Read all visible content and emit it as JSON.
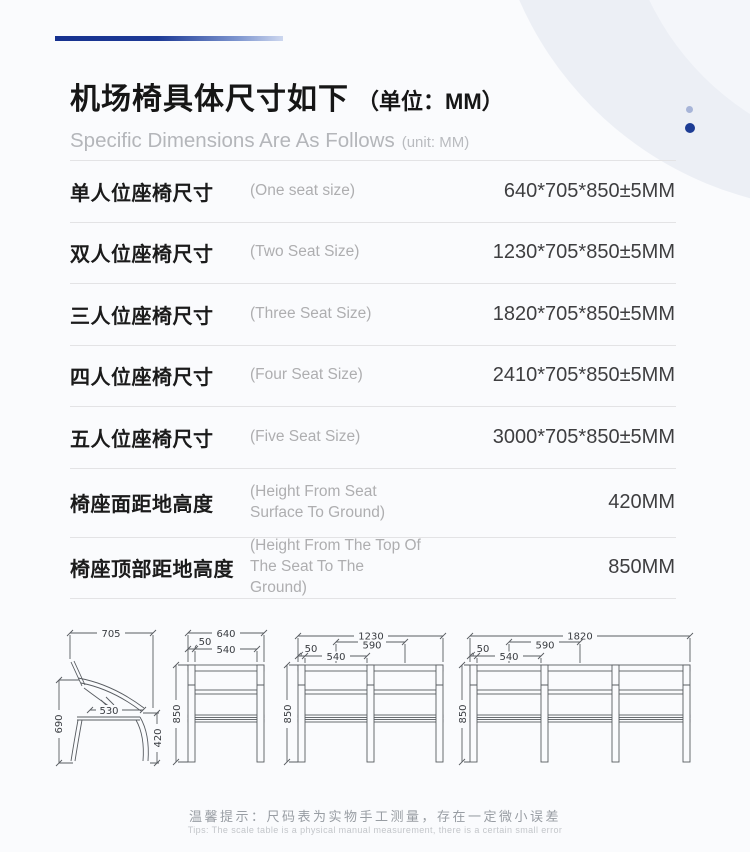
{
  "header": {
    "title_zh": "机场椅具体尺寸如下",
    "title_unit": "（单位：MM）",
    "subtitle_en": "Specific Dimensions Are As Follows",
    "subtitle_unit": "(unit: MM)"
  },
  "spec_table": {
    "rows": [
      {
        "label_zh": "单人位座椅尺寸",
        "label_en": "(One seat size)",
        "value": "640*705*850±5MM"
      },
      {
        "label_zh": "双人位座椅尺寸",
        "label_en": "(Two Seat Size)",
        "value": "1230*705*850±5MM"
      },
      {
        "label_zh": "三人位座椅尺寸",
        "label_en": "(Three Seat Size)",
        "value": "1820*705*850±5MM"
      },
      {
        "label_zh": "四人位座椅尺寸",
        "label_en": "(Four Seat Size)",
        "value": "2410*705*850±5MM"
      },
      {
        "label_zh": "五人位座椅尺寸",
        "label_en": "(Five Seat Size)",
        "value": "3000*705*850±5MM"
      },
      {
        "label_zh": "椅座面距地高度",
        "label_en": "(Height From Seat Surface To Ground)",
        "value": "420MM"
      },
      {
        "label_zh": "椅座顶部距地高度",
        "label_en": "(Height From The Top Of The Seat To The Ground)",
        "value": "850MM"
      }
    ]
  },
  "drawings": {
    "side_view": {
      "total_depth": "705",
      "total_height": "690",
      "seat_depth": "530",
      "seat_height": "420"
    },
    "front_single": {
      "total_width": "640",
      "armrest": "50",
      "seat_width": "540",
      "total_height": "850"
    },
    "front_double": {
      "total_width": "1230",
      "seat_pitch": "590",
      "seat_width": "540",
      "armrest": "50",
      "total_height": "850"
    },
    "front_triple": {
      "total_width": "1820",
      "seat_pitch": "590",
      "seat_width": "540",
      "armrest": "50",
      "total_height": "850"
    }
  },
  "footer": {
    "tip_zh": "温馨提示：尺码表为实物手工测量，存在一定微小误差",
    "tip_en": "Tips: The scale table is a physical manual measurement, there is a certain small error"
  },
  "colors": {
    "accent_dark_blue": "#1d3c94",
    "accent_light_blue": "#a8b5d8",
    "title_text": "#161616",
    "muted_text": "#b4b6ba",
    "value_text": "#3e3e40",
    "separator": "#e3e3e5",
    "drawing_line": "#585c61",
    "page_bg": "#fafbfd"
  }
}
